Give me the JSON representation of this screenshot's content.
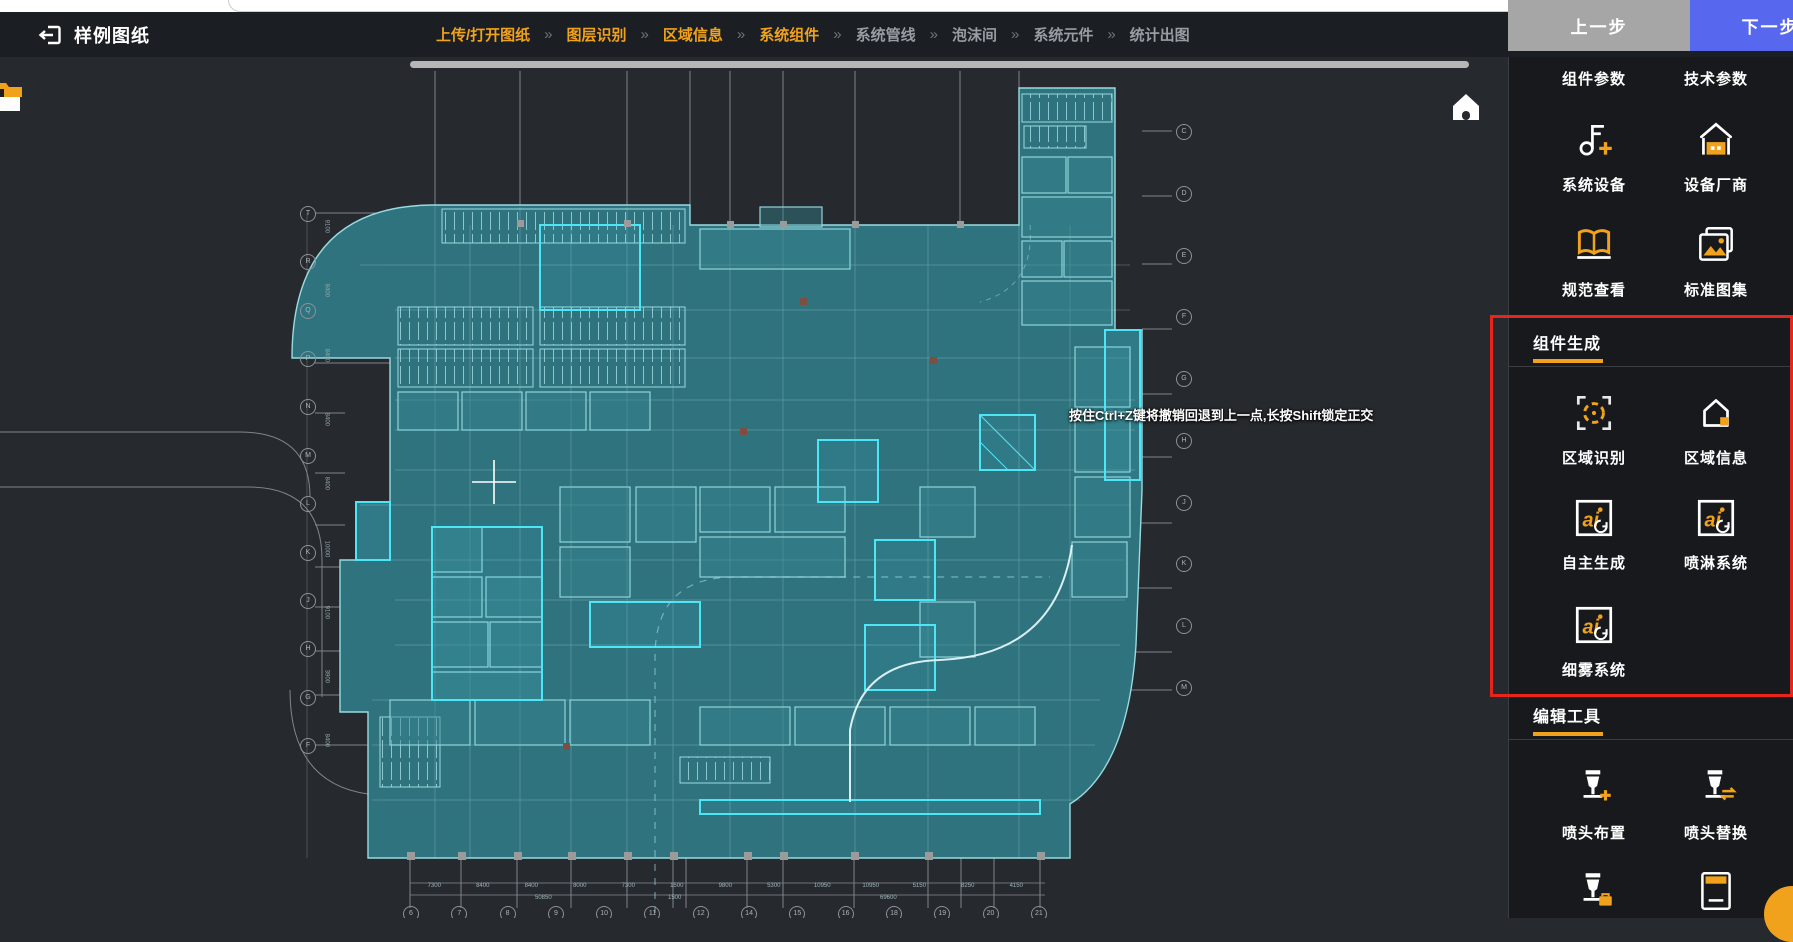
{
  "header": {
    "title": "样例图纸",
    "separator": "»",
    "steps": [
      {
        "label": "上传/打开图纸",
        "active": true
      },
      {
        "label": "图层识别",
        "active": true
      },
      {
        "label": "区域信息",
        "active": true
      },
      {
        "label": "系统组件",
        "active": true
      },
      {
        "label": "系统管线",
        "active": false
      },
      {
        "label": "泡沫间",
        "active": false
      },
      {
        "label": "系统元件",
        "active": false
      },
      {
        "label": "统计出图",
        "active": false
      }
    ],
    "prev_label": "上一步",
    "next_label": "下一步"
  },
  "canvas": {
    "tooltip": "按住Ctrl+Z键将撤销回退到上一点,长按Shift锁定正交",
    "bottom_axis_labels": [
      "6",
      "7",
      "8",
      "9",
      "10",
      "11",
      "12",
      "14",
      "15",
      "16",
      "18",
      "19",
      "20",
      "21"
    ],
    "left_axis_labels": [
      "T",
      "R",
      "Q",
      "P",
      "N",
      "M",
      "L",
      "K",
      "J",
      "H",
      "G",
      "F"
    ],
    "right_axis_labels": [
      "C",
      "D",
      "E",
      "F",
      "G",
      "H",
      "J",
      "K",
      "L",
      "M"
    ],
    "left_dims": [
      "9100",
      "8400",
      "8400",
      "8400",
      "8400",
      "10000",
      "9100",
      "3900",
      "8400"
    ],
    "bottom_dims": [
      "7300",
      "8400",
      "8400",
      "8000",
      "7300",
      "1500",
      "9800",
      "5300",
      "10950",
      "10950",
      "5150",
      "8250",
      "4150"
    ],
    "bottom_totals": [
      "50850",
      "1500",
      "69600"
    ]
  },
  "sidebar": {
    "top_labels": [
      "组件参数",
      "技术参数"
    ],
    "tools": {
      "sys_device": "系统设备",
      "vendor": "设备厂商",
      "spec_view": "规范查看",
      "atlas": "标准图集",
      "region_detect": "区域识别",
      "region_info": "区域信息",
      "auto_gen": "自主生成",
      "sprinkler_sys": "喷淋系统",
      "mist_sys": "细雾系统",
      "head_layout": "喷头布置",
      "head_replace": "喷头替换"
    },
    "sections": {
      "component_gen": "组件生成",
      "edit_tools": "编辑工具"
    },
    "ai_icon_text": "ai"
  },
  "colors": {
    "accent_orange": "#f0a21d",
    "next_blue": "#5868ee",
    "prev_gray": "#a6a6a6",
    "highlight_red": "#e8251a",
    "plan_teal": "#2e737e",
    "plan_cyan": "#4ce6f6"
  }
}
